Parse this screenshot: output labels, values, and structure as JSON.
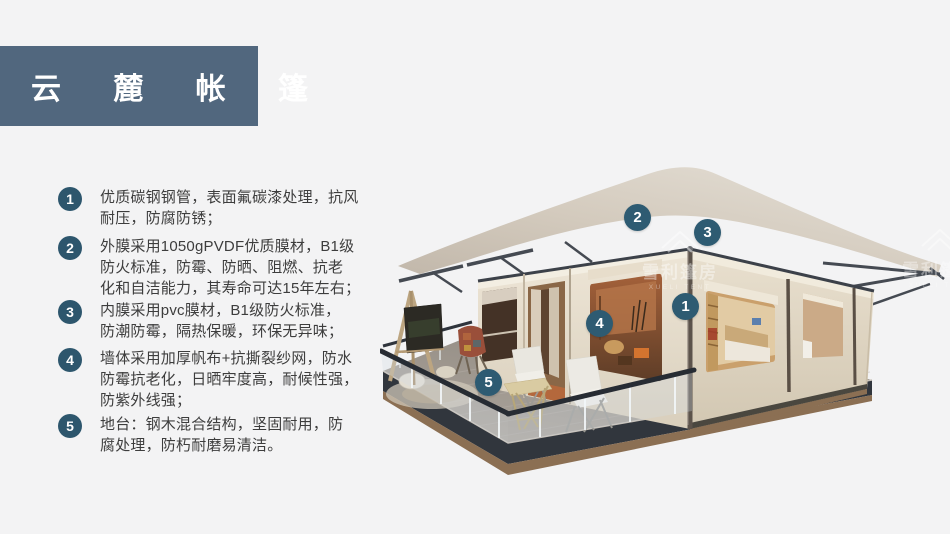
{
  "header": {
    "title": "云 麓 帐 篷"
  },
  "features": [
    {
      "number": "1",
      "text": "优质碳钢钢管，表面氟碳漆处理，抗风\n耐压，防腐防锈；"
    },
    {
      "number": "2",
      "text": "外膜采用1050gPVDF优质膜材，B1级\n防火标准，防霉、防晒、阻燃、抗老\n化和自洁能力，其寿命可达15年左右；"
    },
    {
      "number": "3",
      "text": "内膜采用pvc膜材，B1级防火标准，\n防潮防霉，隔热保暖，环保无异味；"
    },
    {
      "number": "4",
      "text": "墙体采用加厚帆布+抗撕裂纱网，防水\n防霉抗老化，日晒牢度高，耐候性强，\n防紫外线强；"
    },
    {
      "number": "5",
      "text": "地台：钢木混合结构，坚固耐用，防\n腐处理，防朽耐磨易清洁。"
    }
  ],
  "scene_callouts": [
    {
      "number": "2"
    },
    {
      "number": "3"
    },
    {
      "number": "1"
    },
    {
      "number": "4"
    },
    {
      "number": "5"
    }
  ],
  "watermark": {
    "brand": "雪利篷房",
    "brand_en": "XUELI TENT"
  },
  "colors": {
    "background": "#f3f3f4",
    "title_band": "#51677e",
    "badge": "#2d566d",
    "callout": "#2e5b72",
    "text": "#3d3d3d",
    "roof": "#d3cabd",
    "wall_front": "#ece4d4",
    "wall_right": "#e7decd",
    "deck_floor": "#9a938b",
    "deck_fascia": "#31363d",
    "deck_wood": "#8b6f53",
    "railing": "#272c33"
  }
}
